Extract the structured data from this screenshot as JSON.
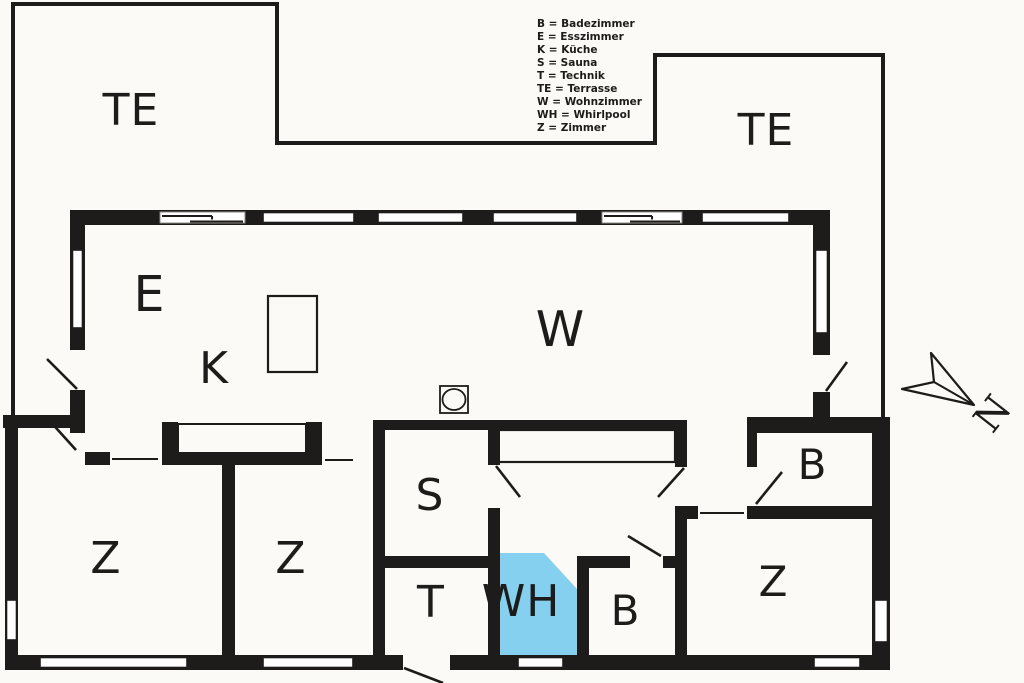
{
  "legend": {
    "items": [
      "B = Badezimmer",
      "E = Esszimmer",
      "K = Küche",
      "S = Sauna",
      "T = Technik",
      "TE = Terrasse",
      "W = Wohnzimmer",
      "WH = Whirlpool",
      "Z = Zimmer"
    ]
  },
  "rooms": {
    "terrace_left": "TE",
    "terrace_right": "TE",
    "dining": "E",
    "kitchen": "K",
    "living": "W",
    "bedroom_left": "Z",
    "bedroom_mid": "Z",
    "sauna": "S",
    "technik": "T",
    "whirlpool": "WH",
    "bath_inner": "B",
    "bath_right": "B",
    "bedroom_right": "Z"
  },
  "compass": {
    "north": "N"
  },
  "colors": {
    "background": "#fbfaf7",
    "wall": "#1d1c1a",
    "whirlpool": "#85cfef",
    "whirlpool_text": "#1c3442"
  }
}
